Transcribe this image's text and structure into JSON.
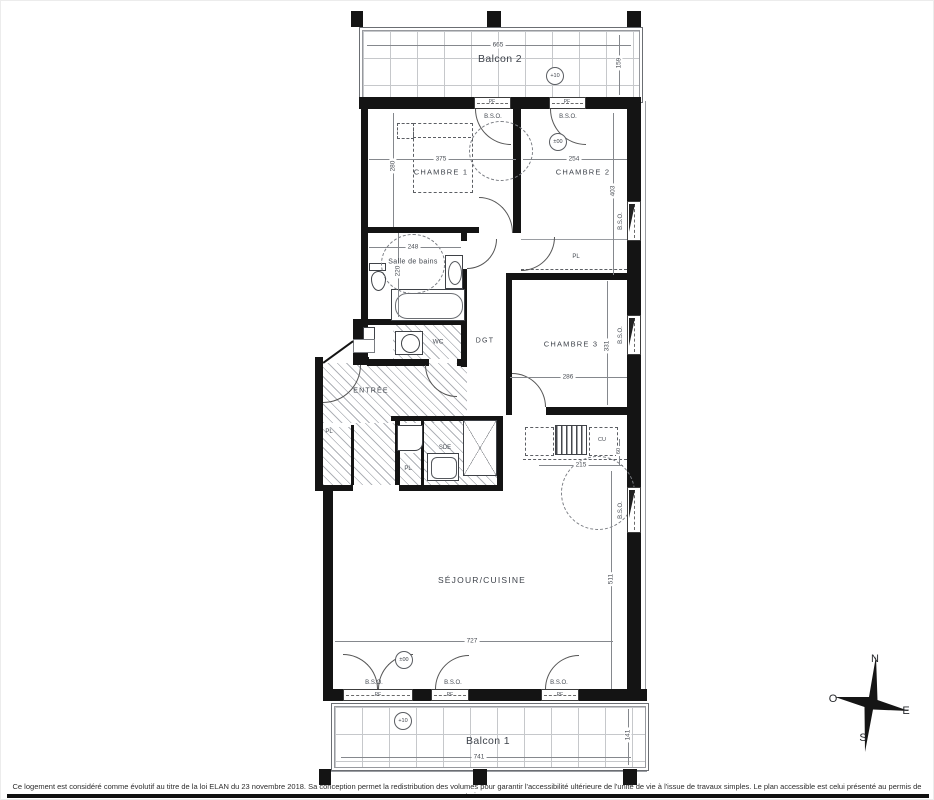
{
  "rooms": {
    "balcon2": "Balcon 2",
    "chambre1": "CHAMBRE 1",
    "chambre2": "CHAMBRE 2",
    "chambre3": "CHAMBRE 3",
    "salle_de_bains": "Salle de bains",
    "wc": "WC",
    "dgt": "DGT",
    "entree": "ENTRÉE",
    "sde": "SDE",
    "cu": "CU",
    "sejour": "SÉJOUR/CUISINE",
    "balcon1": "Balcon 1"
  },
  "labels": {
    "bso": "B.S.O.",
    "pf": "PF",
    "pl": "PL"
  },
  "levels": {
    "balcon2": "+10",
    "chambre2": "±00",
    "sejour": "±00",
    "balcon1": "+10"
  },
  "dimensions_cm": {
    "balcon2_width": "665",
    "balcon2_depth": "159",
    "chambre1_width": "375",
    "chambre1_depth": "280",
    "chambre2_width": "254",
    "chambre2_depth": "403",
    "sdb_width": "248",
    "sdb_depth": "220",
    "chambre3_width": "286",
    "chambre3_depth": "331",
    "cuisine_width": "215",
    "cuisine_depth": "60",
    "sejour_width": "727",
    "sejour_depth": "511",
    "balcon1_width": "741",
    "balcon1_depth": "141"
  },
  "compass": {
    "north": "N",
    "west": "O",
    "east": "E",
    "south": "S"
  },
  "footer": {
    "disclaimer": "Ce logement est considéré comme évolutif au titre de la loi ELAN du 23 novembre 2018. Sa conception permet la redistribution des volumes pour garantir l'accessibilité ultérieure de l'unité de vie à l'issue de travaux simples. Le plan accessible est celui présenté au permis de construire."
  }
}
